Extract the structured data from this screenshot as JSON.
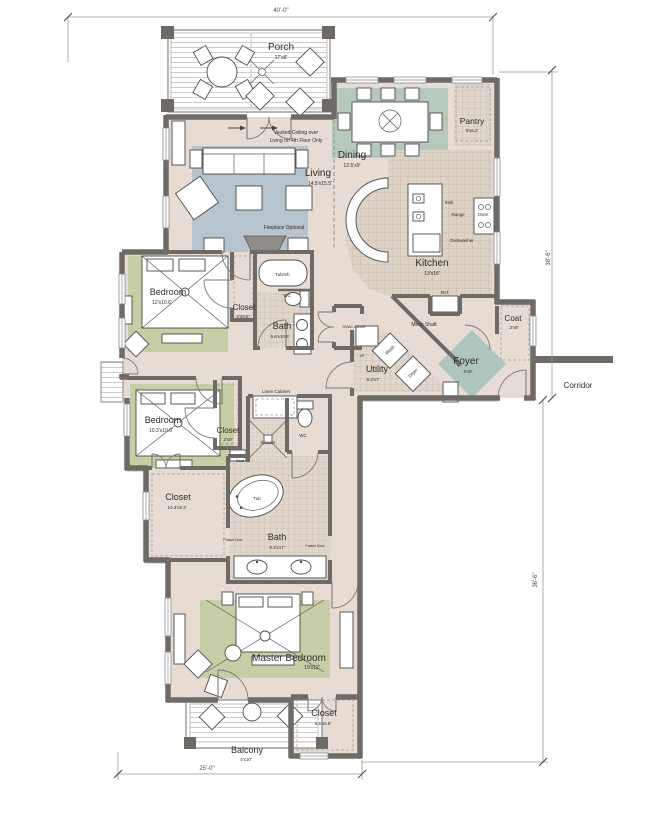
{
  "drawing": {
    "title": "Residential unit floor plan",
    "dimensions": {
      "top": "40'-0\"",
      "right_upper": "38'-6\"",
      "right_lower": "36'-6\"",
      "bottom": "25'-0\""
    },
    "colors": {
      "wall": "#6e6a66",
      "floor": "#e7dcd3",
      "rug_green": "#c7cda5",
      "rug_blue": "#b7c3cd",
      "rug_dining": "#b7c9bb",
      "rug_foyer": "#aec6be",
      "tile_bg": "#ddd2c6",
      "tile_line": "#c0b5a6",
      "deck_line": "#c4c0ba"
    },
    "rooms": [
      {
        "name": "Porch",
        "size": "17'x8'"
      },
      {
        "name": "Living",
        "size": "14.5'x15.5'"
      },
      {
        "name": "Dining",
        "size": "12.5'x9'"
      },
      {
        "name": "Pantry",
        "size": "5'x6.3'"
      },
      {
        "name": "Kitchen",
        "size": "13'x16'"
      },
      {
        "name": "Bedroom",
        "size": "12'x10.6'"
      },
      {
        "name": "Closet",
        "size": "2'x6.6'"
      },
      {
        "name": "Bath",
        "size": "5.6'x10.6'"
      },
      {
        "name": "Utility",
        "size": "8.3'x7'"
      },
      {
        "name": "Foyer",
        "size": "9'x8'"
      },
      {
        "name": "Coat",
        "size": "2'x9'"
      },
      {
        "name": "Corridor",
        "size": ""
      },
      {
        "name": "Bedroom",
        "size": "10.3'x10.6'"
      },
      {
        "name": "Closet",
        "size": "2'x9'"
      },
      {
        "name": "Closet",
        "size": "10.3'x8.3'"
      },
      {
        "name": "Bath",
        "size": "8.3'x17'"
      },
      {
        "name": "Master Bedroom",
        "size": "19'x12'"
      },
      {
        "name": "Closet",
        "size": "6.5'x5.6'"
      },
      {
        "name": "Balcony",
        "size": "4'x10'"
      }
    ],
    "labels": [
      {
        "name": "porch-name",
        "text": "Porch",
        "x": 281,
        "y": 50,
        "fs": 10
      },
      {
        "name": "porch-size",
        "text": "17'x8'",
        "x": 281,
        "y": 59,
        "fs": 5
      },
      {
        "name": "note-vaulted-1",
        "text": "Vaulted Ceiling over",
        "x": 296,
        "y": 134,
        "fs": 5
      },
      {
        "name": "note-vaulted-2",
        "text": "Living on 4th Floor Only",
        "x": 296,
        "y": 142,
        "fs": 5
      },
      {
        "name": "living-name",
        "text": "Living",
        "x": 318,
        "y": 176,
        "fs": 10
      },
      {
        "name": "living-size",
        "text": "14.5'x15.5'",
        "x": 320,
        "y": 185,
        "fs": 5
      },
      {
        "name": "note-fireplace",
        "text": "Fireplace Optional",
        "x": 284,
        "y": 229,
        "fs": 5
      },
      {
        "name": "dining-name",
        "text": "Dining",
        "x": 352,
        "y": 158,
        "fs": 10
      },
      {
        "name": "dining-size",
        "text": "12.5'x9'",
        "x": 352,
        "y": 167,
        "fs": 5
      },
      {
        "name": "pantry-name",
        "text": "Pantry",
        "x": 472,
        "y": 124,
        "fs": 8.5
      },
      {
        "name": "pantry-size",
        "text": "5'x6.3'",
        "x": 472,
        "y": 132,
        "fs": 4.5
      },
      {
        "name": "kitchen-name",
        "text": "Kitchen",
        "x": 432,
        "y": 266,
        "fs": 10
      },
      {
        "name": "kitchen-size",
        "text": "13'x16'",
        "x": 432,
        "y": 275,
        "fs": 5
      },
      {
        "name": "sink-label",
        "text": "Sink",
        "x": 449,
        "y": 204,
        "fs": 4.5
      },
      {
        "name": "range-label",
        "text": "Range",
        "x": 458,
        "y": 216,
        "fs": 4.5
      },
      {
        "name": "oven-label",
        "text": "Oven",
        "x": 483,
        "y": 216,
        "fs": 4.5
      },
      {
        "name": "dishwasher-label",
        "text": "Dishwasher",
        "x": 462,
        "y": 242,
        "fs": 4.5
      },
      {
        "name": "ref-label",
        "text": "Ref.",
        "x": 445,
        "y": 294,
        "fs": 4.5
      },
      {
        "name": "bedroom1-name",
        "text": "Bedroom",
        "x": 168,
        "y": 295,
        "fs": 9
      },
      {
        "name": "bedroom1-size",
        "text": "12'x10.6'",
        "x": 162,
        "y": 304,
        "fs": 5
      },
      {
        "name": "closet1-name",
        "text": "Closet",
        "x": 244,
        "y": 310,
        "fs": 8
      },
      {
        "name": "closet1-size",
        "text": "2'x6.6'",
        "x": 243,
        "y": 318,
        "fs": 4.5
      },
      {
        "name": "bath1-name",
        "text": "Bath",
        "x": 282,
        "y": 329,
        "fs": 9
      },
      {
        "name": "bath1-size",
        "text": "5.6'x10.6'",
        "x": 280,
        "y": 338,
        "fs": 4.5
      },
      {
        "name": "tubsh-label",
        "text": "Tub/Sh.",
        "x": 283,
        "y": 276,
        "fs": 4.5
      },
      {
        "name": "wc1-label",
        "text": "WC",
        "x": 287,
        "y": 297,
        "fs": 4.5
      },
      {
        "name": "hvac-label",
        "text": "HVAC Above",
        "x": 354,
        "y": 328,
        "fs": 4
      },
      {
        "name": "mech-shaft-label",
        "text": "Mech Shaft",
        "x": 424,
        "y": 326,
        "fs": 5
      },
      {
        "name": "utility-name",
        "text": "Utility",
        "x": 377,
        "y": 372,
        "fs": 9
      },
      {
        "name": "utility-size",
        "text": "8.3'x7'",
        "x": 373,
        "y": 381,
        "fs": 4.5
      },
      {
        "name": "wash-label",
        "text": "Wash",
        "x": 391,
        "y": 351,
        "fs": 4.5,
        "rot": -45
      },
      {
        "name": "dryer-label",
        "text": "Dryer",
        "x": 414,
        "y": 374,
        "fs": 4.5,
        "rot": -45
      },
      {
        "name": "up-label",
        "text": "UP",
        "x": 362,
        "y": 357,
        "fs": 3.5
      },
      {
        "name": "foyer-name",
        "text": "Foyer",
        "x": 466,
        "y": 364,
        "fs": 10
      },
      {
        "name": "foyer-size",
        "text": "9'x8'",
        "x": 468,
        "y": 373,
        "fs": 4.5
      },
      {
        "name": "coat-name",
        "text": "Coat",
        "x": 513,
        "y": 321,
        "fs": 8
      },
      {
        "name": "coat-size",
        "text": "2'x9'",
        "x": 514,
        "y": 329,
        "fs": 4.5
      },
      {
        "name": "corridor-name",
        "text": "Corridor",
        "x": 578,
        "y": 388,
        "fs": 8
      },
      {
        "name": "linen-label",
        "text": "Linen Cabinet",
        "x": 276,
        "y": 393,
        "fs": 4.5
      },
      {
        "name": "bedroom2-name",
        "text": "Bedroom",
        "x": 163,
        "y": 423,
        "fs": 9
      },
      {
        "name": "bedroom2-size",
        "text": "10.3'x10.6'",
        "x": 161,
        "y": 432,
        "fs": 5
      },
      {
        "name": "closet2-name",
        "text": "Closet",
        "x": 228,
        "y": 433,
        "fs": 8
      },
      {
        "name": "closet2-size",
        "text": "2'x9'",
        "x": 228,
        "y": 441,
        "fs": 4.5
      },
      {
        "name": "shower-label",
        "text": "Shower",
        "x": 268,
        "y": 444,
        "fs": 4.5
      },
      {
        "name": "wc2-label",
        "text": "WC",
        "x": 303,
        "y": 437,
        "fs": 4.5
      },
      {
        "name": "seat-label",
        "text": "Seat",
        "x": 240,
        "y": 462,
        "fs": 4
      },
      {
        "name": "closet3-name",
        "text": "Closet",
        "x": 178,
        "y": 500,
        "fs": 9
      },
      {
        "name": "closet3-size",
        "text": "10.3'x8.3'",
        "x": 177,
        "y": 509,
        "fs": 4.5
      },
      {
        "name": "tub-label",
        "text": "Tub",
        "x": 257,
        "y": 500,
        "fs": 4.5
      },
      {
        "name": "bath2-name",
        "text": "Bath",
        "x": 277,
        "y": 540,
        "fs": 9
      },
      {
        "name": "bath2-size",
        "text": "8.3'x17'",
        "x": 277,
        "y": 549,
        "fs": 4.5
      },
      {
        "name": "pocket-door-1",
        "text": "Pocket Door",
        "x": 233,
        "y": 541,
        "fs": 3.5
      },
      {
        "name": "pocket-door-2",
        "text": "Pocket Door",
        "x": 315,
        "y": 547,
        "fs": 3.5
      },
      {
        "name": "master-name",
        "text": "Master Bedroom",
        "x": 289,
        "y": 661,
        "fs": 10
      },
      {
        "name": "master-size",
        "text": "19'x12'",
        "x": 312,
        "y": 669,
        "fs": 5
      },
      {
        "name": "closet4-name",
        "text": "Closet",
        "x": 324,
        "y": 716,
        "fs": 9
      },
      {
        "name": "closet4-size",
        "text": "6.5'x5.6'",
        "x": 323,
        "y": 725,
        "fs": 4.5
      },
      {
        "name": "balcony-name",
        "text": "Balcony",
        "x": 247,
        "y": 753,
        "fs": 9
      },
      {
        "name": "balcony-size",
        "text": "4'x10'",
        "x": 246,
        "y": 761,
        "fs": 4.5
      },
      {
        "name": "dim-top",
        "text": "40'-0\"",
        "x": 281,
        "y": 12,
        "fs": 6,
        "cls": "dim"
      },
      {
        "name": "dim-right-upper",
        "text": "38'-6\"",
        "x": 550,
        "y": 258,
        "fs": 6,
        "rot": -90,
        "cls": "dim"
      },
      {
        "name": "dim-right-lower",
        "text": "36'-6\"",
        "x": 537,
        "y": 580,
        "fs": 6,
        "rot": -90,
        "cls": "dim"
      },
      {
        "name": "dim-bottom",
        "text": "25'-0\"",
        "x": 207,
        "y": 770,
        "fs": 6,
        "cls": "dim"
      }
    ]
  }
}
